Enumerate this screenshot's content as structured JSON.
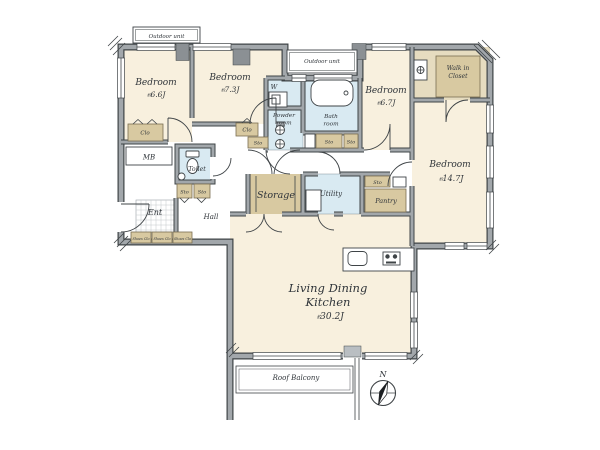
{
  "plan_type": "floor-plan",
  "colors": {
    "room_cream": "#f8f0de",
    "closet_tan": "#d8c9a1",
    "closet_tan_light": "#e6dcc0",
    "wet_area_blue": "#d9eaf2",
    "wall_gray": "#a2a7ab",
    "wall_edge": "#3f4447",
    "pillar_gray": "#8b9094",
    "text": "#30353a"
  },
  "rooms": {
    "bedroom_66": {
      "name": "Bedroom",
      "size": "6.6J"
    },
    "bedroom_73": {
      "name": "Bedroom",
      "size": "7.3J"
    },
    "bedroom_67": {
      "name": "Bedroom",
      "size": "6.7J"
    },
    "bedroom_147": {
      "name": "Bedroom",
      "size": "14.7J"
    },
    "ldk": {
      "name_line1": "Living Dining",
      "name_line2": "Kitchen",
      "size": "30.2J"
    },
    "walk_in_closet": {
      "line1": "Walk in",
      "line2": "Closet"
    },
    "powder_room": {
      "line1": "Powder",
      "line2": "room"
    },
    "bath_room": {
      "line1": "Bath",
      "line2": "room"
    },
    "toilet": "Toilet",
    "washer": "W",
    "utility": "Utility",
    "storage": "Storage",
    "pantry": "Pantry",
    "hall": "Hall",
    "entrance": "Ent",
    "meter_box": "MB"
  },
  "labels": {
    "outdoor_unit": "Outdoor unit",
    "roof_balcony": "Roof Balcony",
    "north": "N",
    "approx": "約",
    "closet": "Clo",
    "storage_small": "Sto",
    "shoes_closet": "Shoes Clo"
  }
}
